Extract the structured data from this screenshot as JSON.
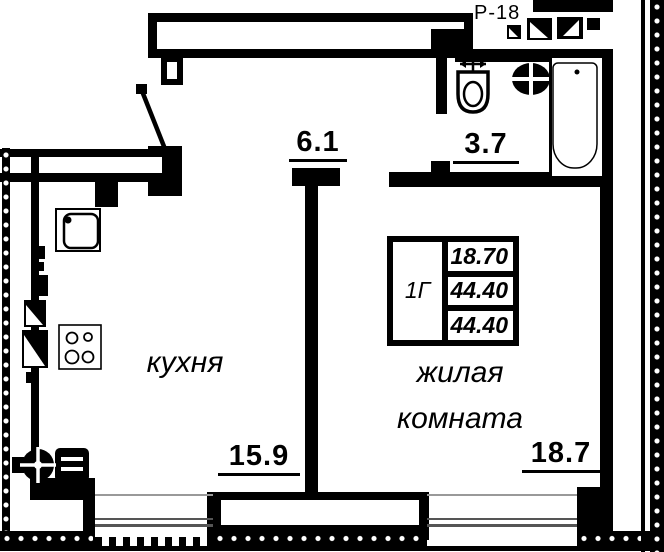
{
  "title": "Р-18",
  "rooms": {
    "hall": {
      "area": "6.1"
    },
    "bathroom": {
      "area": "3.7"
    },
    "kitchen": {
      "name": "кухня",
      "area": "15.9"
    },
    "living_room": {
      "name_line1": "жилая",
      "name_line2": "комната",
      "area": "18.7"
    }
  },
  "area_table": {
    "type": "1Г",
    "values": [
      "18.70",
      "44.40",
      "44.40"
    ]
  },
  "icons": {
    "entrance_door": "door-swing-icon",
    "kitchen_sink": "kitchen-sink-icon",
    "stove": "stove-icon",
    "toilet": "toilet-icon",
    "washbasin": "washbasin-icon",
    "bathtub": "bathtub-icon",
    "radiator": "radiator-icon",
    "vent_shafts": "vent-shaft-icon"
  },
  "colors": {
    "ink": "#000000",
    "paper": "#ffffff",
    "window_line": "#555555"
  }
}
